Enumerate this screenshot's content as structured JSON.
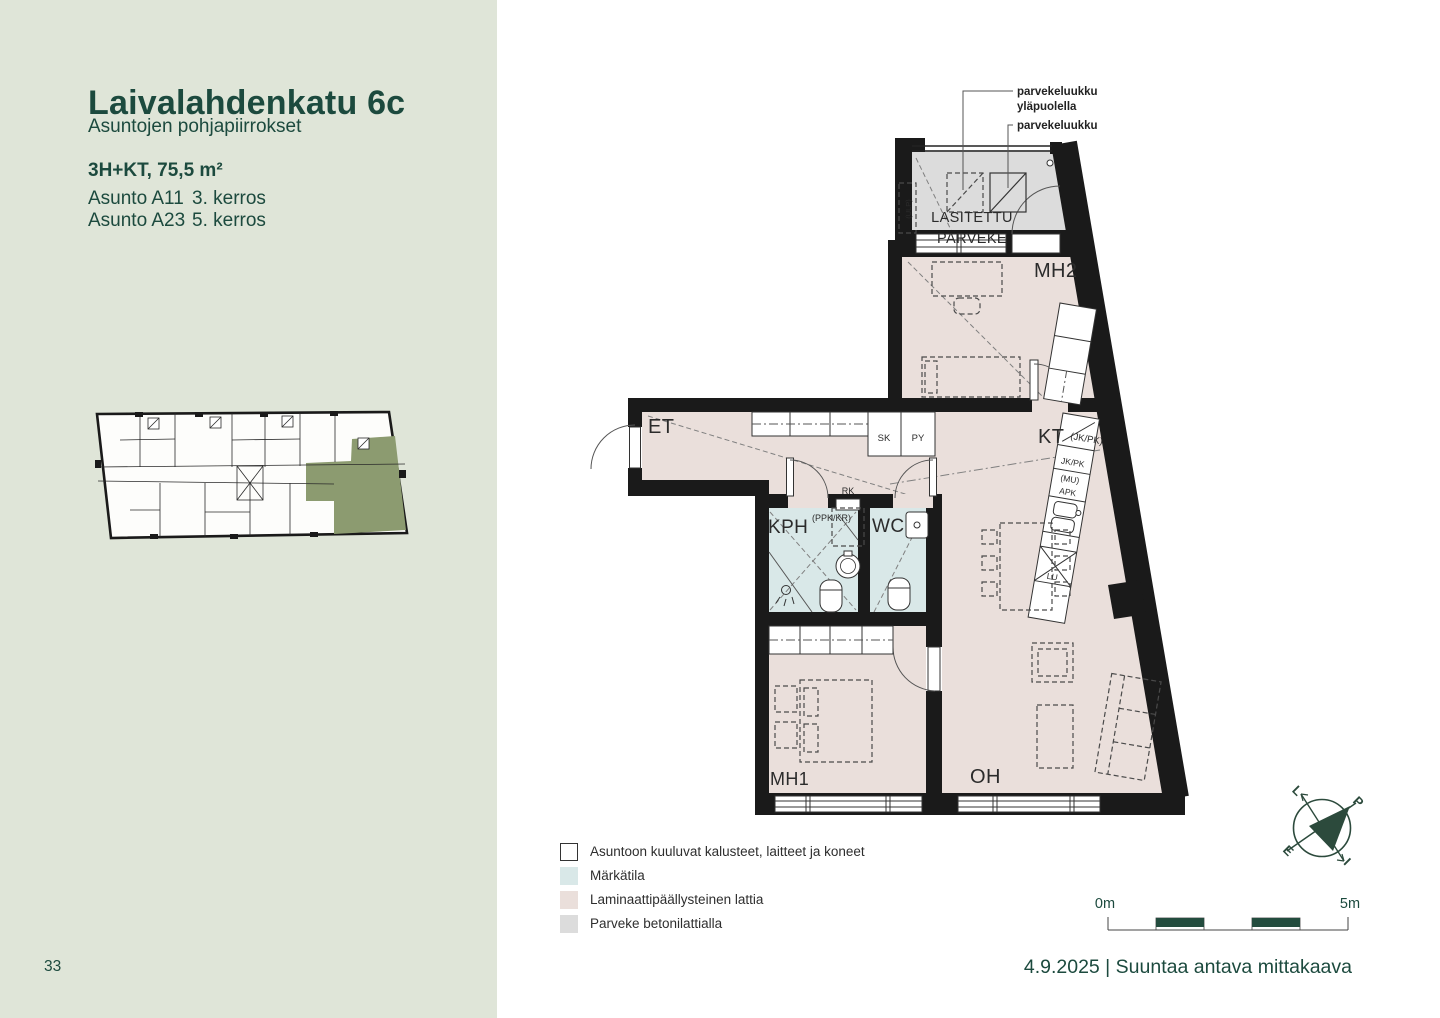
{
  "page": {
    "page_number": "33",
    "footer_note": "4.9.2025 | Suuntaa antava mittakaava"
  },
  "sidebar": {
    "title": "Laivalahdenkatu 6c",
    "subtitle": "Asuntojen pohjapiirrokset",
    "apartment_type": "3H+KT, 75,5 m²",
    "units": [
      {
        "name": "Asunto A11",
        "floor": "3. kerros"
      },
      {
        "name": "Asunto A23",
        "floor": "5. kerros"
      }
    ]
  },
  "plan": {
    "rooms": {
      "et": "ET",
      "kph": "KPH",
      "wc": "WC",
      "kt": "KT",
      "mh1": "MH1",
      "mh2": "MH2",
      "oh": "OH"
    },
    "balcony": {
      "line1": "LASITETTU",
      "line2": "PARVEKE"
    },
    "closets": {
      "sk": "SK",
      "py": "PY"
    },
    "electrical": "RK",
    "laundry": "(PPK/KR)",
    "balcony_vent": "(ULP)",
    "kitchen": {
      "reserved": "(JK/PK)",
      "fridge": "JK/PK",
      "microwave": "(MU)",
      "dishwasher": "APK",
      "stove": "LU"
    },
    "annotations": {
      "hatch_above_1": "parvekeluukku",
      "hatch_above_2": "yläpuolella",
      "hatch": "parvekeluukku"
    },
    "compass": {
      "west": "L",
      "north": "P",
      "south": "E",
      "east": "I"
    }
  },
  "legend": {
    "items": [
      {
        "label": "Asuntoon kuuluvat kalusteet, laitteet ja koneet",
        "swatch": "furniture"
      },
      {
        "label": "Märkätila",
        "swatch": "wet"
      },
      {
        "label": "Laminaattipäällysteinen lattia",
        "swatch": "laminate"
      },
      {
        "label": "Parveke betonilattialla",
        "swatch": "balcony"
      }
    ]
  },
  "scale_bar": {
    "start": "0m",
    "end": "5m"
  },
  "colors": {
    "accent_green": "#1c4a3e",
    "sidebar_bg": "#dfe5d8",
    "laminate_floor": "#eadfdb",
    "wet_floor": "#d9e8e8",
    "balcony_floor": "#dcdcdc",
    "highlight_apartment": "#8c9b70",
    "walls": "#1a1a1a"
  }
}
